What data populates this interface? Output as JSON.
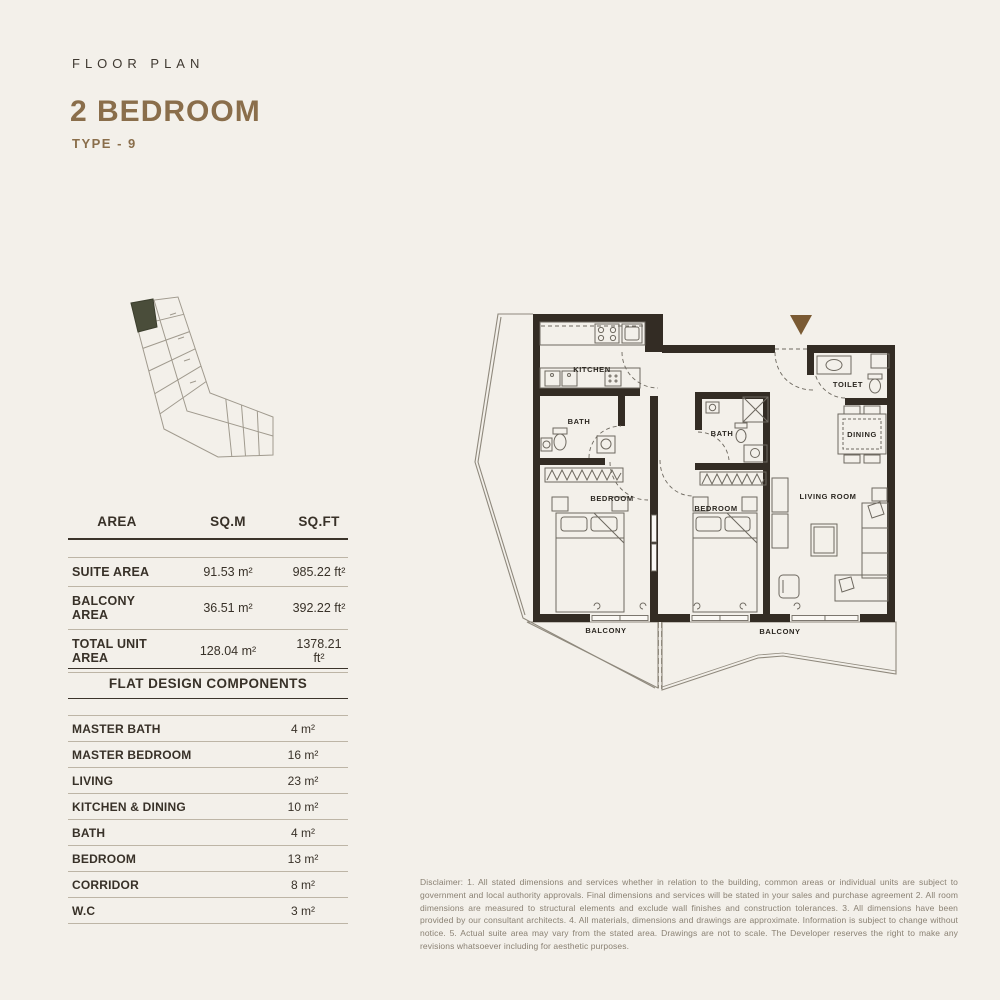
{
  "header": {
    "eyebrow": "FLOOR PLAN",
    "title": "2 BEDROOM",
    "subtitle": "TYPE - 9"
  },
  "colors": {
    "background": "#f3f0ea",
    "title_brown": "#8a6e4b",
    "wall": "#332c24",
    "keyplan_highlight": "#4a4d3a",
    "entrance_arrow": "#7a5a33"
  },
  "area_table": {
    "col_area": "AREA",
    "col_sqm": "SQ.M",
    "col_sqft": "SQ.FT",
    "rows": [
      {
        "label": "SUITE AREA",
        "sqm": "91.53 m²",
        "sqft": "985.22 ft²"
      },
      {
        "label": "BALCONY AREA",
        "sqm": "36.51 m²",
        "sqft": "392.22 ft²"
      },
      {
        "label": "TOTAL UNIT AREA",
        "sqm": "128.04 m²",
        "sqft": "1378.21 ft²"
      }
    ]
  },
  "components_table": {
    "title": "FLAT DESIGN COMPONENTS",
    "rows": [
      {
        "label": "MASTER BATH",
        "value": "4 m²"
      },
      {
        "label": "MASTER BEDROOM",
        "value": "16 m²"
      },
      {
        "label": "LIVING",
        "value": "23 m²"
      },
      {
        "label": "KITCHEN & DINING",
        "value": "10 m²"
      },
      {
        "label": "BATH",
        "value": "4 m²"
      },
      {
        "label": "BEDROOM",
        "value": "13 m²"
      },
      {
        "label": "CORRIDOR",
        "value": "8 m²"
      },
      {
        "label": "W.C",
        "value": "3 m²"
      }
    ]
  },
  "floor_plan": {
    "labels": {
      "kitchen": "KITCHEN",
      "bath_1": "BATH",
      "bath_2": "BATH",
      "bedroom_1": "BEDROOM",
      "bedroom_2": "BEDROOM",
      "toilet": "TOILET",
      "dining": "DINING",
      "living_room": "LIVING ROOM",
      "balcony_1": "BALCONY",
      "balcony_2": "BALCONY"
    }
  },
  "disclaimer": "Disclaimer: 1. All stated dimensions and services whether in relation to the building, common areas or individual units are subject to government and local authority approvals. Final dimensions and services will be stated in your sales and purchase agreement 2. All room dimensions are measured to structural elements and exclude wall finishes and construction tolerances. 3. All dimensions have been provided by our consultant architects. 4. All materials, dimensions and drawings are approximate. Information is subject to change without notice. 5. Actual suite area may vary from the stated area. Drawings are not to scale. The Developer reserves the right to make any revisions whatsoever including for aesthetic purposes."
}
